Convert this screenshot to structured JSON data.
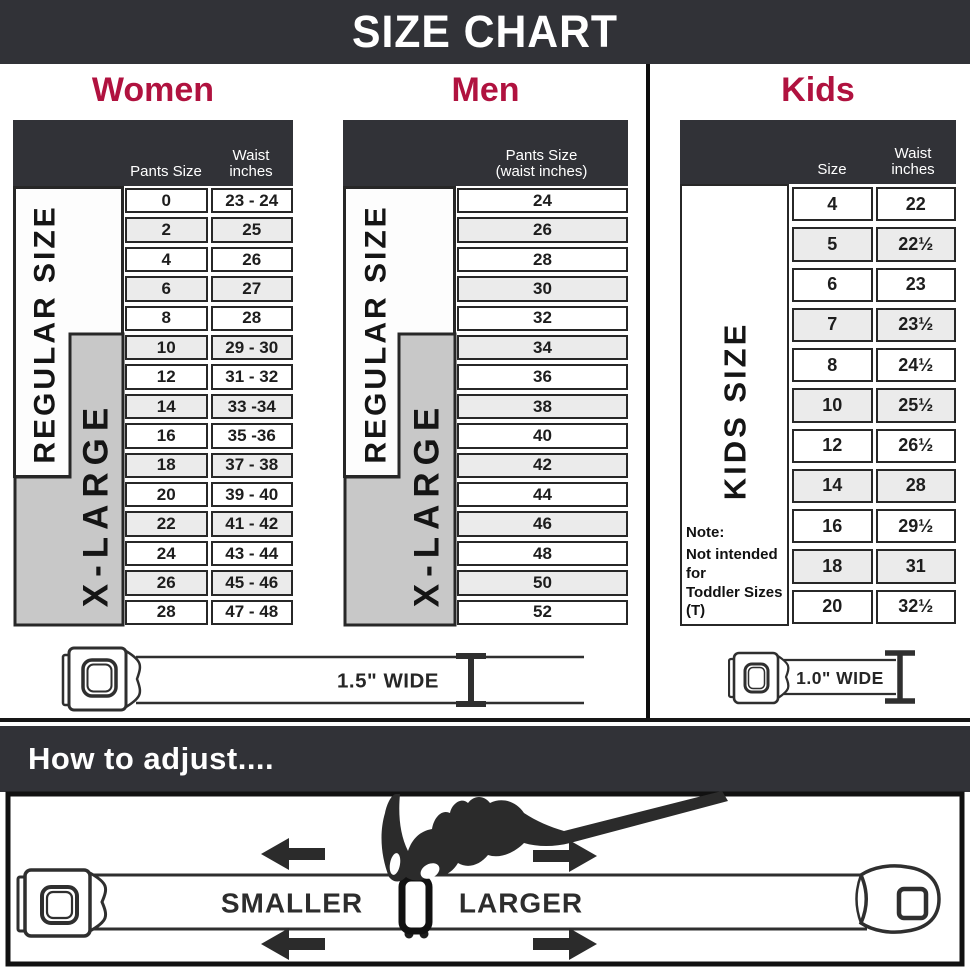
{
  "banner": {
    "title": "SIZE CHART"
  },
  "colors": {
    "dark": "#313237",
    "accent": "#b0123f",
    "xlarge_gray": "#c8c8c8",
    "row_alt": "#ebebeb",
    "line": "#2f2f2f"
  },
  "sections": {
    "women": {
      "title": "Women",
      "header": {
        "pants": "Pants Size",
        "waist_line1": "Waist",
        "waist_line2": "inches"
      },
      "regular_label": "REGULAR SIZE",
      "xlarge_label": "X-LARGE",
      "rows": [
        {
          "size": "0",
          "waist": "23 - 24"
        },
        {
          "size": "2",
          "waist": "25"
        },
        {
          "size": "4",
          "waist": "26"
        },
        {
          "size": "6",
          "waist": "27"
        },
        {
          "size": "8",
          "waist": "28"
        },
        {
          "size": "10",
          "waist": "29 - 30"
        },
        {
          "size": "12",
          "waist": "31 - 32"
        },
        {
          "size": "14",
          "waist": "33 -34"
        },
        {
          "size": "16",
          "waist": "35 -36"
        },
        {
          "size": "18",
          "waist": "37 - 38"
        },
        {
          "size": "20",
          "waist": "39 - 40"
        },
        {
          "size": "22",
          "waist": "41 - 42"
        },
        {
          "size": "24",
          "waist": "43 - 44"
        },
        {
          "size": "26",
          "waist": "45 - 46"
        },
        {
          "size": "28",
          "waist": "47 - 48"
        }
      ]
    },
    "men": {
      "title": "Men",
      "header": {
        "line1": "Pants Size",
        "line2": "(waist inches)"
      },
      "regular_label": "REGULAR SIZE",
      "xlarge_label": "X-LARGE",
      "rows": [
        "24",
        "26",
        "28",
        "30",
        "32",
        "34",
        "36",
        "38",
        "40",
        "42",
        "44",
        "46",
        "48",
        "50",
        "52"
      ]
    },
    "kids": {
      "title": "Kids",
      "header": {
        "size": "Size",
        "waist_line1": "Waist",
        "waist_line2": "inches"
      },
      "side_label": "KIDS SIZE",
      "note_line1": "Note:",
      "note_line2": "Not intended for",
      "note_line3": "Toddler Sizes (T)",
      "rows": [
        {
          "size": "4",
          "waist": "22"
        },
        {
          "size": "5",
          "waist": "22½"
        },
        {
          "size": "6",
          "waist": "23"
        },
        {
          "size": "7",
          "waist": "23½"
        },
        {
          "size": "8",
          "waist": "24½"
        },
        {
          "size": "10",
          "waist": "25½"
        },
        {
          "size": "12",
          "waist": "26½"
        },
        {
          "size": "14",
          "waist": "28"
        },
        {
          "size": "16",
          "waist": "29½"
        },
        {
          "size": "18",
          "waist": "31"
        },
        {
          "size": "20",
          "waist": "32½"
        }
      ]
    }
  },
  "belts": {
    "adult_width_label": "1.5\" WIDE",
    "kids_width_label": "1.0\" WIDE"
  },
  "adjust": {
    "heading": "How to adjust....",
    "smaller": "SMALLER",
    "larger": "LARGER"
  }
}
